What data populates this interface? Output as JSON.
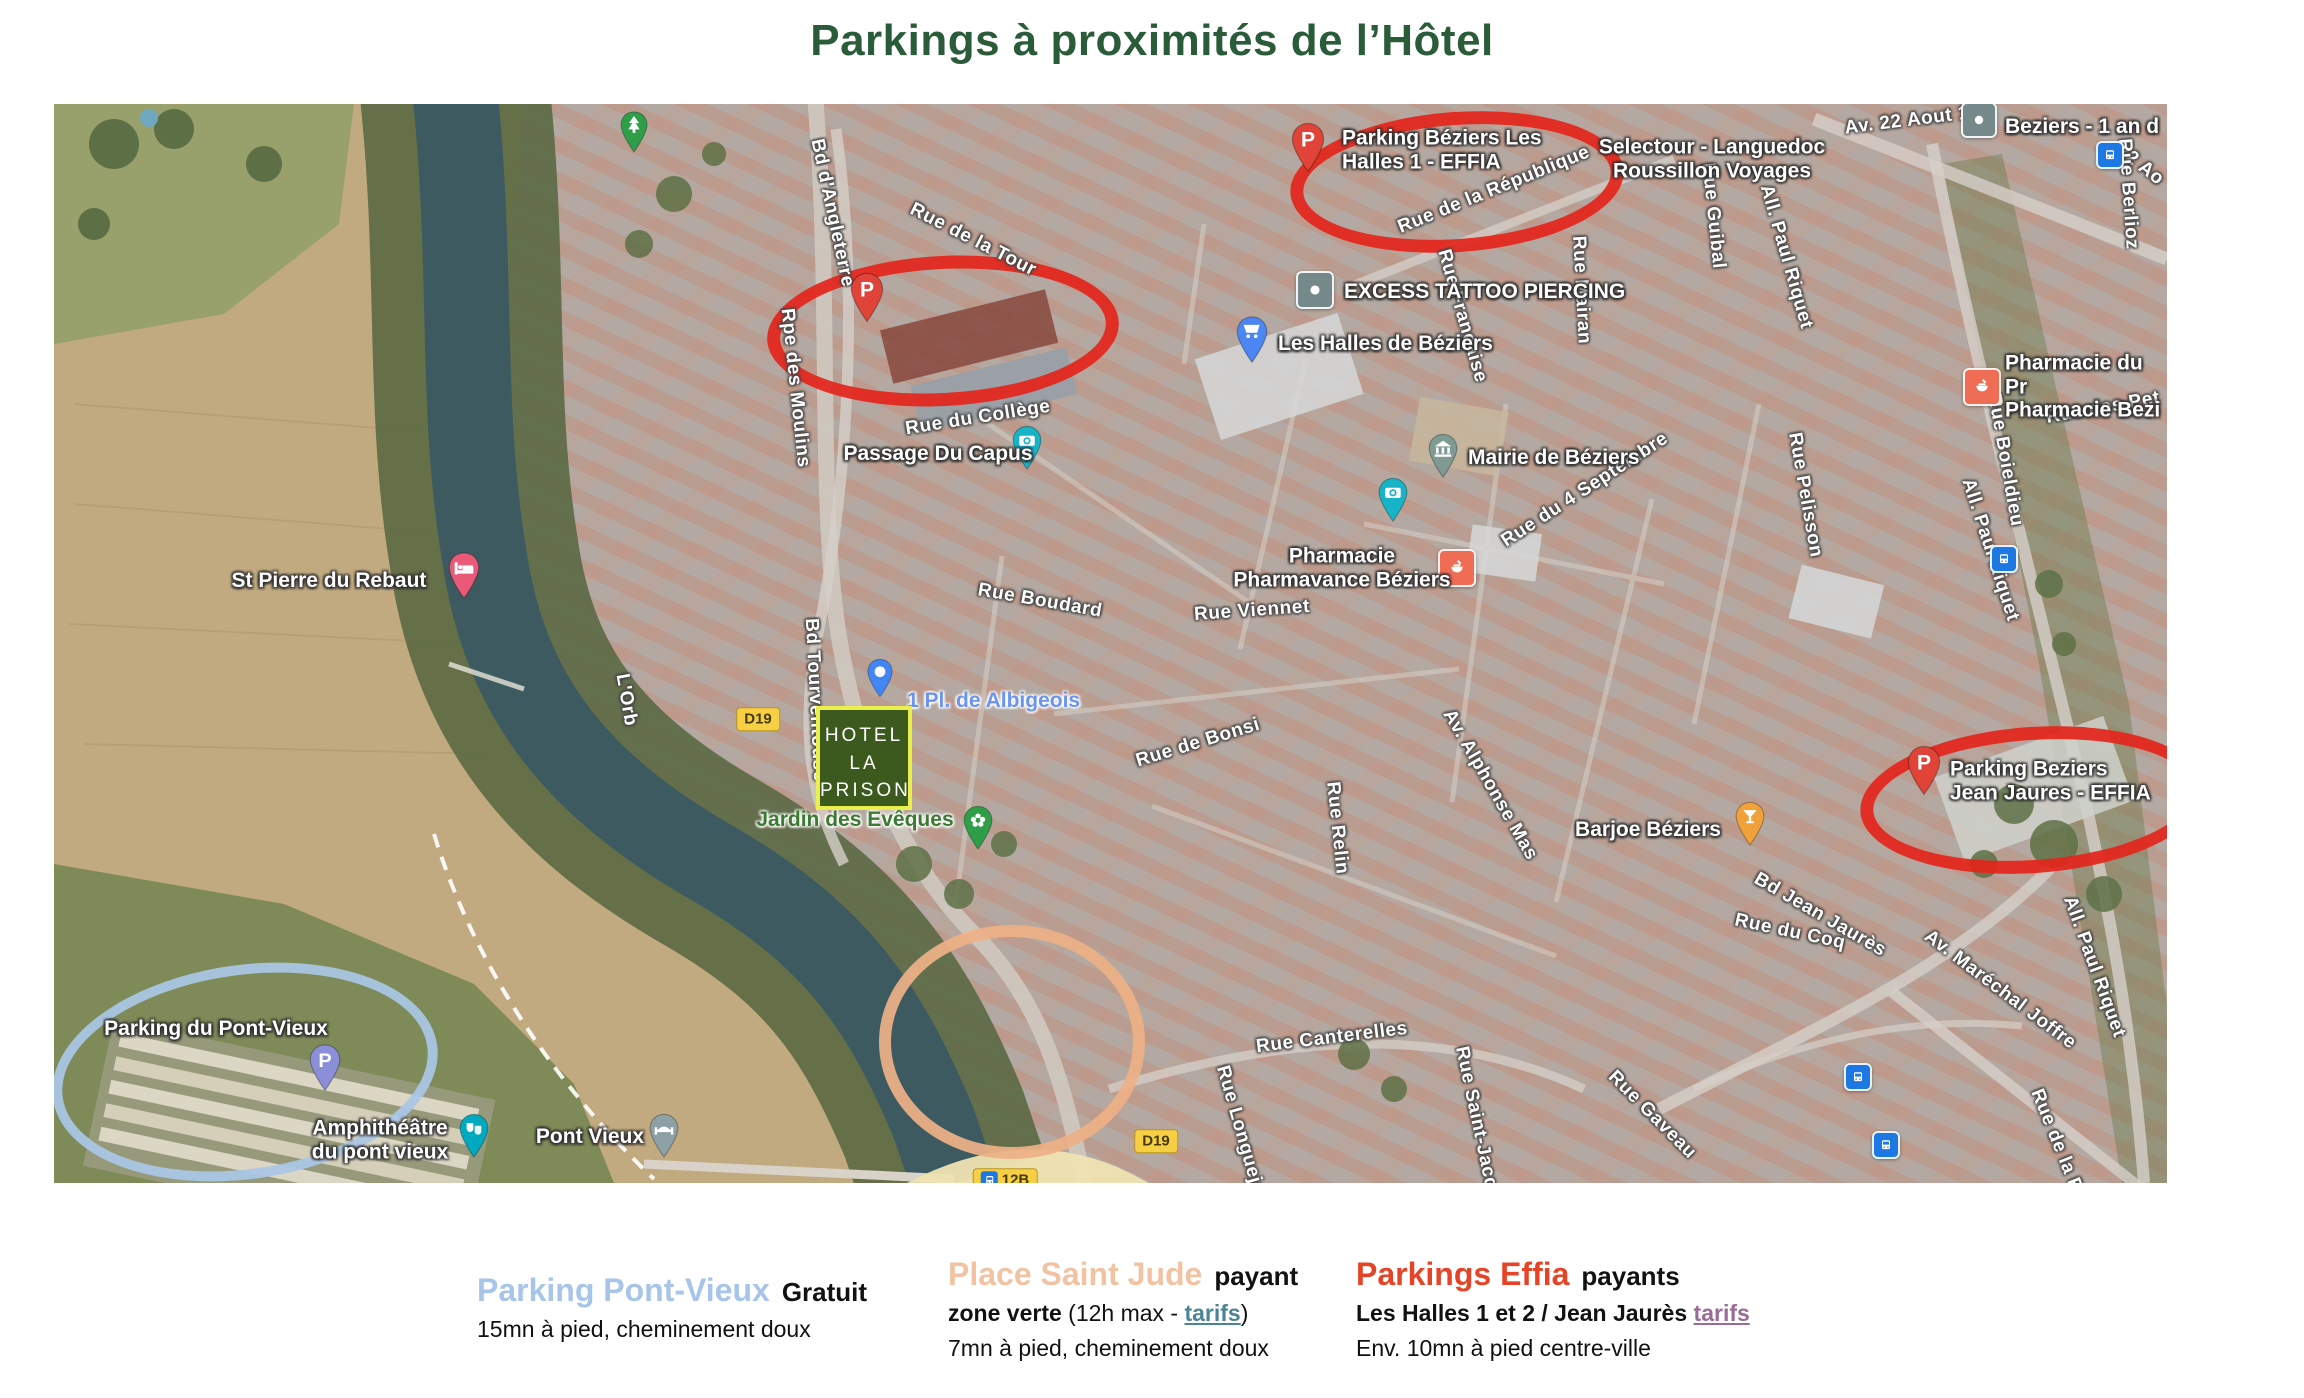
{
  "title": "Parkings à proximités de l’Hôtel",
  "colors": {
    "title": "#2a5c3a",
    "highlight_red": "#e3261c",
    "highlight_blue": "#aac7e6",
    "highlight_orange": "#edb087"
  },
  "map": {
    "hotel_logo": [
      "HOTEL",
      "LA",
      "PRISON"
    ],
    "ellipses": [
      {
        "name": "red-ellipse-parking-les-halles",
        "x": 1390,
        "y": 65,
        "rx": 154,
        "ry": 57,
        "w": 13,
        "r": -4,
        "color": "#e3261c"
      },
      {
        "name": "red-ellipse-parking-centre",
        "x": 876,
        "y": 214,
        "rx": 163,
        "ry": 62,
        "w": 13,
        "r": -3,
        "color": "#e3261c"
      },
      {
        "name": "red-ellipse-parking-jean-jaures",
        "x": 1966,
        "y": 683,
        "rx": 160,
        "ry": 60,
        "w": 13,
        "r": -4,
        "color": "#e3261c"
      },
      {
        "name": "blue-ellipse-parking-pont-vieux",
        "x": 181,
        "y": 958,
        "rx": 184,
        "ry": 97,
        "w": 10,
        "r": -8,
        "color": "#aac7e6"
      },
      {
        "name": "orange-ellipse-place-saint-jude",
        "x": 946,
        "y": 926,
        "rx": 121,
        "ry": 105,
        "w": 12,
        "r": 0,
        "color": "#edb087"
      }
    ],
    "street_labels": [
      {
        "t": "Av. 22 Aout 1",
        "x": 1853,
        "y": 17,
        "r": -7
      },
      {
        "t": "22 Ao",
        "x": 2086,
        "y": 61,
        "r": 38
      },
      {
        "t": "Rue de la République",
        "x": 1440,
        "y": 86,
        "r": -22
      },
      {
        "t": "Rue Guibal",
        "x": 1659,
        "y": 112,
        "r": 84
      },
      {
        "t": "All. Paul Riquet",
        "x": 1732,
        "y": 153,
        "r": 74
      },
      {
        "t": "Rue Berlioz",
        "x": 2074,
        "y": 90,
        "r": 86
      },
      {
        "t": "Bd d'Angleterre",
        "x": 778,
        "y": 109,
        "r": 78
      },
      {
        "t": "Rue de la Tour",
        "x": 919,
        "y": 136,
        "r": 27
      },
      {
        "t": "Rue Française",
        "x": 1408,
        "y": 212,
        "r": 74
      },
      {
        "t": "Rue Mairan",
        "x": 1527,
        "y": 186,
        "r": 87
      },
      {
        "t": "Rue du Collège",
        "x": 924,
        "y": 314,
        "r": -9
      },
      {
        "t": "Rue du 4 Septembre",
        "x": 1531,
        "y": 386,
        "r": -33
      },
      {
        "t": "Rue Pelisson",
        "x": 1751,
        "y": 391,
        "r": 80
      },
      {
        "t": "Rpe des Moulins",
        "x": 741,
        "y": 284,
        "r": 84
      },
      {
        "t": "Rue Boudard",
        "x": 986,
        "y": 497,
        "r": 10
      },
      {
        "t": "Rue Viennet",
        "x": 1198,
        "y": 507,
        "r": -4
      },
      {
        "t": "Rue des Pet",
        "x": 2049,
        "y": 304,
        "r": -10
      },
      {
        "t": "Rue Boieldieu",
        "x": 1951,
        "y": 356,
        "r": 80
      },
      {
        "t": "All. Paul Riquet",
        "x": 1936,
        "y": 446,
        "r": 72
      },
      {
        "t": "Bd Tourventouse",
        "x": 761,
        "y": 596,
        "r": 87
      },
      {
        "t": "L'Orb",
        "x": 572,
        "y": 596,
        "r": 80
      },
      {
        "t": "Rue de Bonsi",
        "x": 1144,
        "y": 639,
        "r": -17
      },
      {
        "t": "Rue Relin",
        "x": 1283,
        "y": 724,
        "r": 84
      },
      {
        "t": "Av. Alphonse Mas",
        "x": 1436,
        "y": 681,
        "r": 60
      },
      {
        "t": "Bd Jean Jaurès",
        "x": 1766,
        "y": 811,
        "r": 30
      },
      {
        "t": "Rue du Coq",
        "x": 1736,
        "y": 828,
        "r": 12
      },
      {
        "t": "Av. Maréchal Joffre",
        "x": 1946,
        "y": 886,
        "r": 37
      },
      {
        "t": "All. Paul Riquet",
        "x": 2040,
        "y": 863,
        "r": 70
      },
      {
        "t": "Rue Gaveau",
        "x": 1598,
        "y": 1011,
        "r": 45
      },
      {
        "t": "Rue de la Rot",
        "x": 2006,
        "y": 1046,
        "r": 68
      },
      {
        "t": "Rue Canterelles",
        "x": 1278,
        "y": 934,
        "r": -7
      },
      {
        "t": "Rue Longueja",
        "x": 1186,
        "y": 1026,
        "r": 74
      },
      {
        "t": "Rue Saint-Jacq",
        "x": 1422,
        "y": 1014,
        "r": 78
      }
    ],
    "poi_labels": [
      {
        "name": "selectour-label",
        "t": "Selectour - Languedoc\nRoussillon Voyages",
        "x": 1658,
        "y": 55,
        "align": "center"
      },
      {
        "name": "beziers-1-an-label",
        "t": "Beziers - 1 an d",
        "x": 1951,
        "y": 23,
        "align": "left"
      },
      {
        "name": "parking-les-halles-label",
        "t": "Parking Béziers Les\nHalles 1 - EFFIA",
        "x": 1288,
        "y": 46,
        "align": "left"
      },
      {
        "name": "excess-tattoo-label",
        "t": "EXCESS TATTOO PIERCING",
        "x": 1290,
        "y": 188,
        "align": "left"
      },
      {
        "name": "les-halles-label",
        "t": "Les Halles de Béziers",
        "x": 1224,
        "y": 240,
        "align": "left"
      },
      {
        "name": "passage-du-capus-label",
        "t": "Passage Du Capus",
        "x": 884,
        "y": 350,
        "align": "center"
      },
      {
        "name": "mairie-label",
        "t": "Mairie de Béziers",
        "x": 1414,
        "y": 354,
        "align": "left"
      },
      {
        "name": "pharmacie-pharmavance-label",
        "t": "Pharmacie\nPharmavance Béziers",
        "x": 1288,
        "y": 464,
        "align": "center"
      },
      {
        "name": "st-pierre-du-rebaut-label",
        "t": "St Pierre du Rebaut",
        "x": 275,
        "y": 477,
        "align": "center"
      },
      {
        "name": "parking-jean-jaures-label",
        "t": "Parking Beziers\nJean Jaures - EFFIA",
        "x": 1896,
        "y": 677,
        "align": "left"
      },
      {
        "name": "barjoe-label",
        "t": "Barjoe Béziers",
        "x": 1594,
        "y": 726,
        "align": "center"
      },
      {
        "name": "parking-pont-vieux-label",
        "t": "Parking du Pont-Vieux",
        "x": 162,
        "y": 925,
        "align": "center"
      },
      {
        "name": "amphitheatre-label",
        "t": "Amphithéâtre\ndu pont vieux",
        "x": 326,
        "y": 1036,
        "align": "center"
      },
      {
        "name": "pont-vieux-label",
        "t": "Pont Vieux",
        "x": 536,
        "y": 1033,
        "align": "center"
      },
      {
        "name": "albigeois-label",
        "t": "1 Pl. de Albigeois",
        "x": 853,
        "y": 597,
        "align": "left",
        "color": "#6b93f0"
      },
      {
        "name": "jardin-des-eveques-label",
        "t": "Jardin des Evêques",
        "x": 801,
        "y": 716,
        "align": "center",
        "color": "#3c7a33"
      },
      {
        "name": "pharmacie-du-progres-label",
        "t": "Pharmacie du Pr\nPharmacie Bezi",
        "x": 1951,
        "y": 283,
        "align": "left"
      }
    ],
    "markers": [
      {
        "name": "park-tree-pin",
        "kind": "pin",
        "icon": "tree",
        "color": "#2f9e49",
        "x": 580,
        "y": 30,
        "size": 30
      },
      {
        "name": "parking-les-halles-pin",
        "kind": "pin",
        "icon": "parking",
        "color": "#e04438",
        "x": 1254,
        "y": 46,
        "size": 36
      },
      {
        "name": "parking-centre-pin",
        "kind": "pin",
        "icon": "parking",
        "color": "#e04438",
        "x": 813,
        "y": 196,
        "size": 36
      },
      {
        "name": "les-halles-cart-pin",
        "kind": "pin",
        "icon": "cart",
        "color": "#4b86f2",
        "x": 1198,
        "y": 238,
        "size": 34
      },
      {
        "name": "passage-du-capus-camera-pin",
        "kind": "pin",
        "icon": "camera",
        "color": "#17b3c7",
        "x": 973,
        "y": 346,
        "size": 32
      },
      {
        "name": "photo-spot-camera-pin",
        "kind": "pin",
        "icon": "camera",
        "color": "#17b3c7",
        "x": 1339,
        "y": 398,
        "size": 32
      },
      {
        "name": "mairie-bank-pin",
        "kind": "pin",
        "icon": "bank",
        "color": "#7e9a93",
        "x": 1389,
        "y": 354,
        "size": 32
      },
      {
        "name": "st-pierre-du-rebaut-bed-pin",
        "kind": "pin",
        "icon": "bed",
        "color": "#e85a78",
        "x": 410,
        "y": 474,
        "size": 34
      },
      {
        "name": "albigeois-dot-pin",
        "kind": "pin",
        "icon": "dot",
        "color": "#4285f4",
        "x": 826,
        "y": 576,
        "size": 28
      },
      {
        "name": "jardin-des-eveques-flower-pin",
        "kind": "pin",
        "icon": "flower",
        "color": "#2f9e49",
        "x": 924,
        "y": 726,
        "size": 32
      },
      {
        "name": "barjoe-cocktail-pin",
        "kind": "pin",
        "icon": "cocktail",
        "color": "#f0a13a",
        "x": 1696,
        "y": 722,
        "size": 32
      },
      {
        "name": "parking-jean-jaures-pin",
        "kind": "pin",
        "icon": "parking",
        "color": "#e04438",
        "x": 1870,
        "y": 669,
        "size": 36
      },
      {
        "name": "parking-pont-vieux-pin",
        "kind": "pin",
        "icon": "parking",
        "color": "#8a8fd8",
        "x": 271,
        "y": 966,
        "size": 34
      },
      {
        "name": "amphitheatre-masks-pin",
        "kind": "pin",
        "icon": "masks",
        "color": "#00a9bd",
        "x": 420,
        "y": 1034,
        "size": 32
      },
      {
        "name": "pont-vieux-bridge-pin",
        "kind": "pin",
        "icon": "bridge",
        "color": "#8da0a5",
        "x": 610,
        "y": 1034,
        "size": 32
      },
      {
        "name": "beziers-poi-square",
        "kind": "square",
        "icon": "dotglyph",
        "color": "#75898a",
        "x": 1925,
        "y": 16,
        "size": 32
      },
      {
        "name": "excess-tattoo-square",
        "kind": "square",
        "icon": "dotglyph",
        "color": "#75898a",
        "x": 1261,
        "y": 186,
        "size": 34
      },
      {
        "name": "pharmacie-pharmavance-square",
        "kind": "square",
        "icon": "pharmacy",
        "color": "#ef6c55",
        "x": 1403,
        "y": 464,
        "size": 34
      },
      {
        "name": "pharmacie-du-progres-square",
        "kind": "square",
        "icon": "pharmacy",
        "color": "#ef6c55",
        "x": 1928,
        "y": 283,
        "size": 34
      },
      {
        "name": "bus-stop-1",
        "kind": "square",
        "icon": "bus",
        "color": "#1d78e2",
        "x": 2056,
        "y": 51,
        "size": 24
      },
      {
        "name": "bus-stop-2",
        "kind": "square",
        "icon": "bus",
        "color": "#1d78e2",
        "x": 1950,
        "y": 455,
        "size": 24
      },
      {
        "name": "bus-stop-3",
        "kind": "square",
        "icon": "bus",
        "color": "#1d78e2",
        "x": 1804,
        "y": 973,
        "size": 24
      },
      {
        "name": "bus-stop-4",
        "kind": "square",
        "icon": "bus",
        "color": "#1d78e2",
        "x": 1832,
        "y": 1041,
        "size": 24
      }
    ],
    "badges": [
      {
        "name": "route-badge-d19-a",
        "t": "D19",
        "x": 704,
        "y": 615
      },
      {
        "name": "route-badge-d19-b",
        "t": "D19",
        "x": 1102,
        "y": 1037
      },
      {
        "name": "route-badge-12b",
        "t": "12B",
        "x": 951,
        "y": 1076,
        "bus": true
      }
    ]
  },
  "legend": {
    "columns": [
      {
        "name": "legend-parking-pont-vieux",
        "x": 477,
        "y": 1272,
        "title": "Parking Pont-Vieux",
        "title_color": "#a6c5e9",
        "suffix": "Gratuit",
        "lines": [
          [
            {
              "t": "15mn à pied, cheminement doux"
            }
          ]
        ]
      },
      {
        "name": "legend-place-saint-jude",
        "x": 948,
        "y": 1256,
        "title": "Place Saint Jude",
        "title_color": "#f1c3a3",
        "suffix": "payant",
        "lines": [
          [
            {
              "t": "zone verte",
              "b": true
            },
            {
              "t": " (12h max - "
            },
            {
              "t": "tarifs",
              "link": "#4b8495"
            },
            {
              "t": ")"
            }
          ],
          [
            {
              "t": "7mn à pied, cheminement doux"
            }
          ]
        ]
      },
      {
        "name": "legend-parkings-effia",
        "x": 1356,
        "y": 1256,
        "title": "Parkings Effia",
        "title_color": "#e54427",
        "suffix": "payants",
        "lines": [
          [
            {
              "t": "Les Halles 1 et 2 / Jean Jaurès ",
              "b": true
            },
            {
              "t": "tarifs",
              "link": "#9b6b97"
            }
          ],
          [
            {
              "t": "Env. 10mn à pied centre-ville"
            }
          ]
        ]
      }
    ]
  }
}
